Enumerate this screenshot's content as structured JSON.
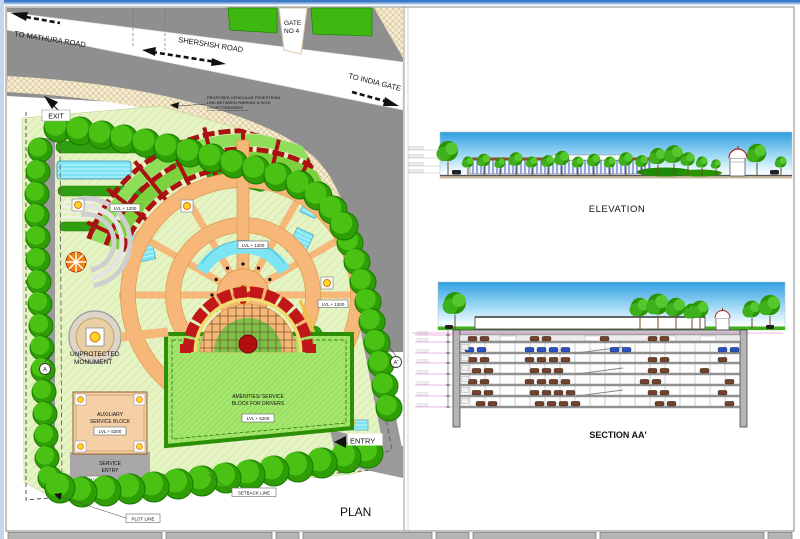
{
  "drawing": {
    "plan": {
      "title": "PLAN",
      "roads": {
        "to_mathura": "TO MATHURA ROAD",
        "shershsh": "SHERSHSH ROAD",
        "to_india_gate": "TO INDIA GATE",
        "gate_line1": "GATE",
        "gate_line2": "NO 4"
      },
      "note": {
        "line1": "PROPOSED VEHICULAR PEDESTRIAN",
        "line2": "LINK BETWEEN PARKING & HIGH",
        "line3": "COURT PREMISES"
      },
      "gates": {
        "exit": "EXIT",
        "entry": "ENTRY"
      },
      "monument": {
        "line1": "UNPROTECTED",
        "line2": "MONUMENT"
      },
      "aux_block": {
        "line1": "AUXILIARY",
        "line2": "SERVICE BLOCK",
        "level": "LVL + 5200"
      },
      "service_entry": {
        "line1": "SERVICE",
        "line2": "ENTRY",
        "level": "LVL +0"
      },
      "amenities_block": {
        "line1": "AMENITIES/ SERVICE",
        "line2": "BLOCK FOR DRIVERS",
        "level": "LVL + 5200"
      },
      "path_levels": {
        "west": "LVL + 1200",
        "center": "LVL + 1200",
        "east": "LVL + 1200"
      },
      "lines": {
        "setback": "SETBACK LINE",
        "plot": "PLOT LINE"
      },
      "section_markers": {
        "a": "A",
        "a_prime": "A'"
      }
    },
    "elevation": {
      "title": "ELEVATION"
    },
    "section": {
      "title": "SECTION AA'"
    },
    "colors": {
      "road_gray": "#8f8f8f",
      "path_orange": "#f6b778",
      "pergola_red": "#aa1111",
      "water_cyan": "#7ce4f2",
      "tree_green": "#3fb711",
      "sky_blue": "#2f9fe0",
      "dimension_magenta": "#e070d0",
      "car_blue": "#2a52c8",
      "car_brown": "#74422a"
    }
  }
}
